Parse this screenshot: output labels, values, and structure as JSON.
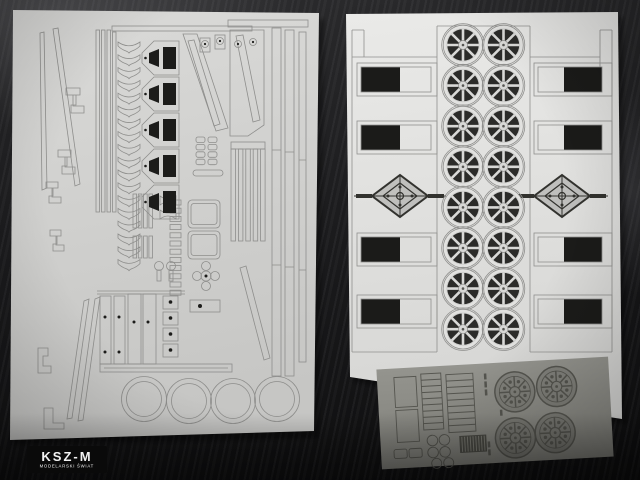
{
  "scene": {
    "description": "Photograph of laser-cut card model kit sheets lying on a dark desk",
    "desk_color": "#1d1d1f"
  },
  "watermark": {
    "title": "KSZ-M",
    "subtitle": "MODELARSKI ŚWIAT",
    "background": "#0a0a0a",
    "color": "#f2f2f2"
  },
  "left_sheet": {
    "label": "frame and chassis parts sheet",
    "paper_color_top": "#dadad8",
    "paper_color_bottom": "#c6c6c4",
    "cut_line_color": "#8e8e8c",
    "window_color": "#1c1c1a",
    "chevron_count": 18,
    "hopper_count": 5,
    "tire_ring_count": 4
  },
  "right_sheet": {
    "label": "spoked wheel parts sheet",
    "paper_color_top": "#eaeae8",
    "paper_color_bottom": "#d6d6d4",
    "cut_line_color": "#90908e",
    "wheel_rows": 8,
    "wheel_columns": 2,
    "spokes_per_wheel": 8,
    "wheel_face_color": "#e2e2e0",
    "wheel_dark_color": "#2b2b29",
    "panel_count": 8,
    "panel_color": "#1b1b19",
    "ornament_count": 2,
    "ornament_color": "#32322e"
  },
  "grey_sheet": {
    "label": "etched detail sheet",
    "paper_color_top": "#94948e",
    "paper_color_bottom": "#7f7f79",
    "line_color": "#55554f",
    "grille_color": "#4a4a44",
    "ornate_wheel_count": 4,
    "ladder_count": 2,
    "disc_count": 6
  }
}
